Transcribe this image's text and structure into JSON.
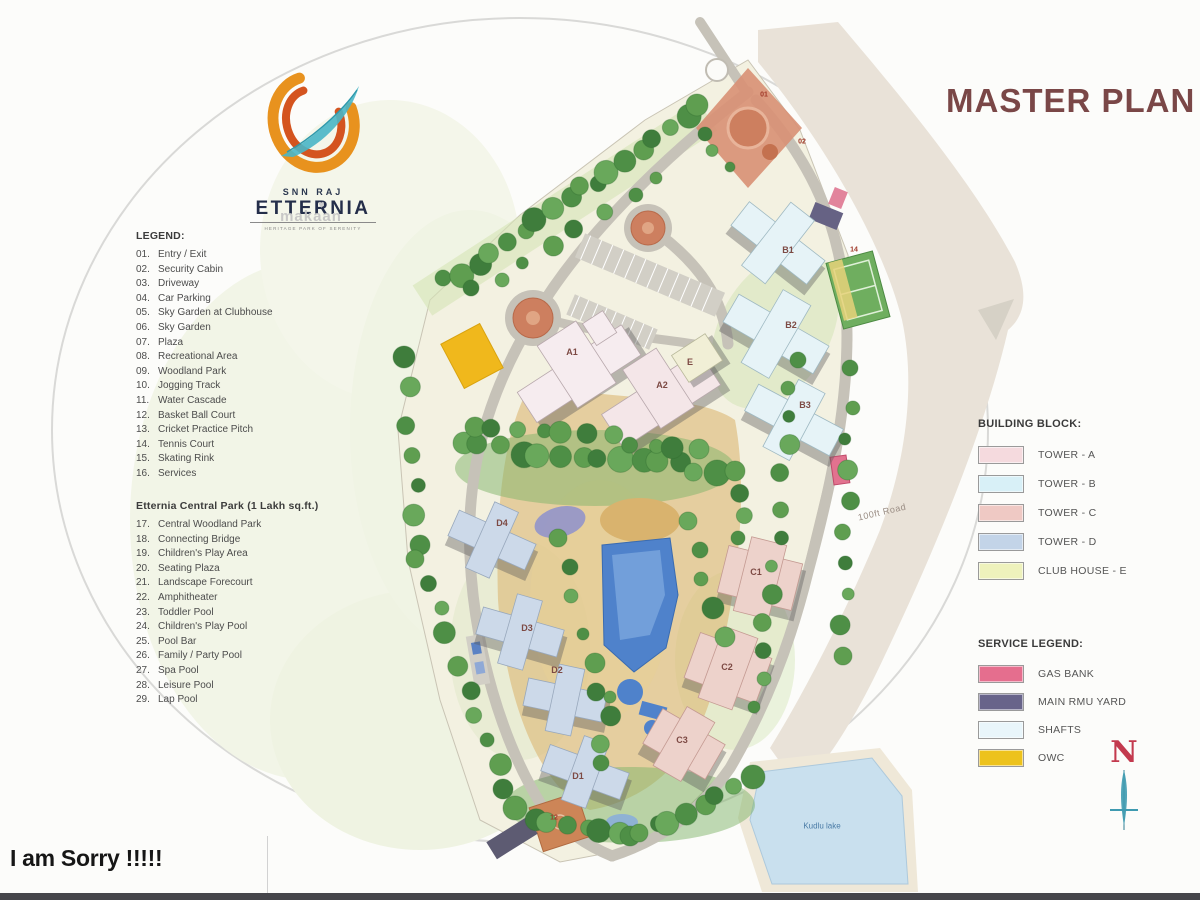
{
  "title": "MASTER PLAN",
  "logo": {
    "brand_top": "SNN RAJ",
    "brand": "ETTERNIA",
    "tagline": "HERITAGE PARK OF SERENITY",
    "watermark": "makaan"
  },
  "legend": {
    "heading": "LEGEND:",
    "items": [
      {
        "num": "01.",
        "label": "Entry / Exit"
      },
      {
        "num": "02.",
        "label": "Security Cabin"
      },
      {
        "num": "03.",
        "label": "Driveway"
      },
      {
        "num": "04.",
        "label": "Car Parking"
      },
      {
        "num": "05.",
        "label": "Sky Garden at Clubhouse"
      },
      {
        "num": "06.",
        "label": "Sky Garden"
      },
      {
        "num": "07.",
        "label": "Plaza"
      },
      {
        "num": "08.",
        "label": "Recreational Area"
      },
      {
        "num": "09.",
        "label": "Woodland Park"
      },
      {
        "num": "10.",
        "label": "Jogging Track"
      },
      {
        "num": "11.",
        "label": "Water Cascade"
      },
      {
        "num": "12.",
        "label": "Basket Ball Court"
      },
      {
        "num": "13.",
        "label": "Cricket Practice Pitch"
      },
      {
        "num": "14.",
        "label": "Tennis Court"
      },
      {
        "num": "15.",
        "label": "Skating Rink"
      },
      {
        "num": "16.",
        "label": "Services"
      }
    ]
  },
  "park_legend": {
    "heading": "Etternia Central Park (1 Lakh sq.ft.)",
    "items": [
      {
        "num": "17.",
        "label": "Central Woodland Park"
      },
      {
        "num": "18.",
        "label": "Connecting Bridge"
      },
      {
        "num": "19.",
        "label": "Children's Play Area"
      },
      {
        "num": "20.",
        "label": "Seating Plaza"
      },
      {
        "num": "21.",
        "label": "Landscape Forecourt"
      },
      {
        "num": "22.",
        "label": "Amphitheater"
      },
      {
        "num": "23.",
        "label": "Toddler Pool"
      },
      {
        "num": "24.",
        "label": "Children's Play Pool"
      },
      {
        "num": "25.",
        "label": "Pool Bar"
      },
      {
        "num": "26.",
        "label": "Family / Party Pool"
      },
      {
        "num": "27.",
        "label": "Spa Pool"
      },
      {
        "num": "28.",
        "label": "Leisure Pool"
      },
      {
        "num": "29.",
        "label": "Lap Pool"
      }
    ]
  },
  "building_block": {
    "heading": "BUILDING BLOCK:",
    "items": [
      {
        "label": "TOWER - A",
        "color": "#f5dade"
      },
      {
        "label": "TOWER - B",
        "color": "#d8f0f7"
      },
      {
        "label": "TOWER - C",
        "color": "#efc9c4"
      },
      {
        "label": "TOWER - D",
        "color": "#c3d4e8"
      },
      {
        "label": "CLUB HOUSE - E",
        "color": "#eef2bc"
      }
    ]
  },
  "service_legend": {
    "heading": "SERVICE LEGEND:",
    "items": [
      {
        "label": "GAS BANK",
        "color": "#e56e8e"
      },
      {
        "label": "MAIN RMU YARD",
        "color": "#68648a"
      },
      {
        "label": "SHAFTS",
        "color": "#e9f6fb"
      },
      {
        "label": "OWC",
        "color": "#edc21c"
      }
    ]
  },
  "map": {
    "tower_labels": {
      "a1": "A1",
      "a2": "A2",
      "e": "E",
      "b1": "B1",
      "b2": "B2",
      "b3": "B3",
      "c1": "C1",
      "c2": "C2",
      "c3": "C3",
      "d1": "D1",
      "d2": "D2",
      "d3": "D3",
      "d4": "D4"
    },
    "markers": {
      "m01": "01",
      "m02": "02",
      "m12": "12",
      "m14": "14"
    },
    "road_label": "100ft Road",
    "lake_label": "Kudlu lake"
  },
  "compass": {
    "label": "N"
  },
  "footer": {
    "message": "I am Sorry !!!!!"
  },
  "colors": {
    "title": "#7a4747",
    "compass_n": "#c33a4e"
  }
}
